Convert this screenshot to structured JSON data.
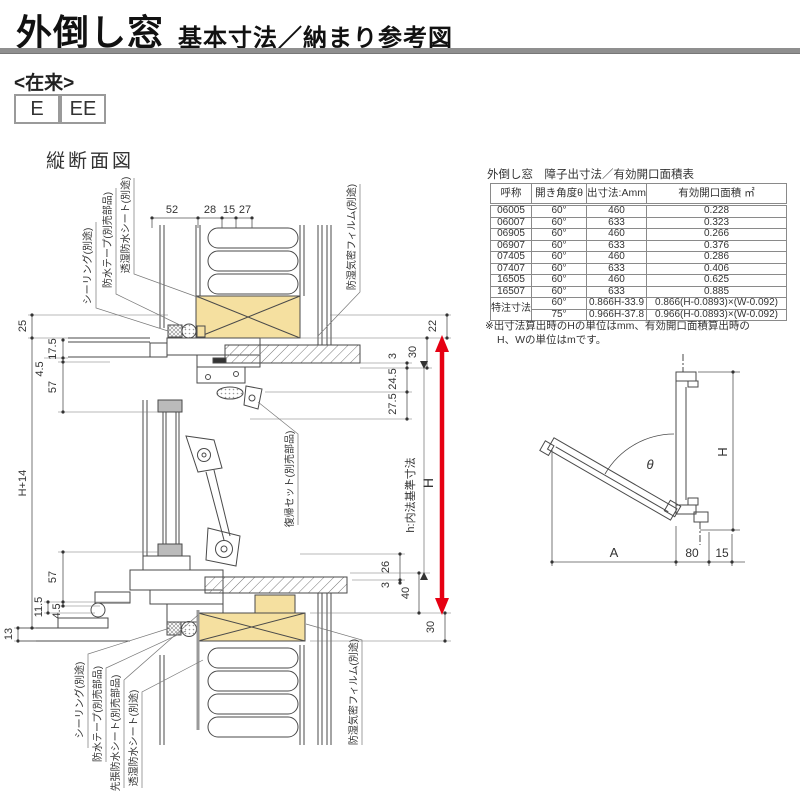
{
  "header": {
    "title_main": "外倒し窓",
    "title_sub": "基本寸法／納まり参考図",
    "series_label": "<在来>",
    "codes": [
      "E",
      "EE"
    ]
  },
  "section": {
    "label": "縦断面図"
  },
  "table": {
    "title": "外倒し窓　障子出寸法／有効開口面積表",
    "headers": [
      "呼称",
      "開き角度θ",
      "出寸法:Amm",
      "有効開口面積 ㎡"
    ],
    "rows": [
      [
        "06005",
        "60°",
        "460",
        "0.228"
      ],
      [
        "06007",
        "60°",
        "633",
        "0.323"
      ],
      [
        "06905",
        "60°",
        "460",
        "0.266"
      ],
      [
        "06907",
        "60°",
        "633",
        "0.376"
      ],
      [
        "07405",
        "60°",
        "460",
        "0.286"
      ],
      [
        "07407",
        "60°",
        "633",
        "0.406"
      ],
      [
        "16505",
        "60°",
        "460",
        "0.625"
      ],
      [
        "16507",
        "60°",
        "633",
        "0.885"
      ]
    ],
    "custom": {
      "label": "特注寸法",
      "rows": [
        [
          "60°",
          "0.866H-33.9",
          "0.866(H-0.0893)×(W-0.092)"
        ],
        [
          "75°",
          "0.966H-37.8",
          "0.966(H-0.0893)×(W-0.092)"
        ]
      ]
    },
    "note_line1": "※出寸法算出時のHの単位はmm、有効開口面積算出時の",
    "note_line2": "H、Wの単位はmです。"
  },
  "dims": {
    "top": [
      "52",
      "28",
      "15",
      "27"
    ],
    "left": [
      "25",
      "17.5",
      "4.5",
      "57",
      "H+14",
      "57",
      "11.5",
      "4.5",
      "13"
    ],
    "right": [
      "22",
      "30",
      "3",
      "24.5",
      "27.5",
      "26",
      "3",
      "40",
      "30"
    ],
    "h_label": "H",
    "h_basis": "h:内法基準寸法"
  },
  "callouts": {
    "top_left": [
      "シーリング(別途)",
      "防水テープ(別売部品)",
      "透湿防水シート(別途)"
    ],
    "top_right": "防湿気密フィルム(別途)",
    "middle": "復帰セット(別売部品)",
    "bottom_left": [
      "シーリング(別途)",
      "防水テープ(別売部品)",
      "先張防水シート(別売部品)",
      "透湿防水シート(別途)"
    ],
    "bottom_right": "防湿気密フィルム(別途)"
  },
  "angle_diagram": {
    "theta": "θ",
    "height_label": "H",
    "width_label": "A",
    "dim_80": "80",
    "dim_15": "15"
  },
  "colors": {
    "accent_red": "#e60012",
    "wood_fill": "#f5e0a0",
    "header_rule": "#8f8f8f"
  }
}
